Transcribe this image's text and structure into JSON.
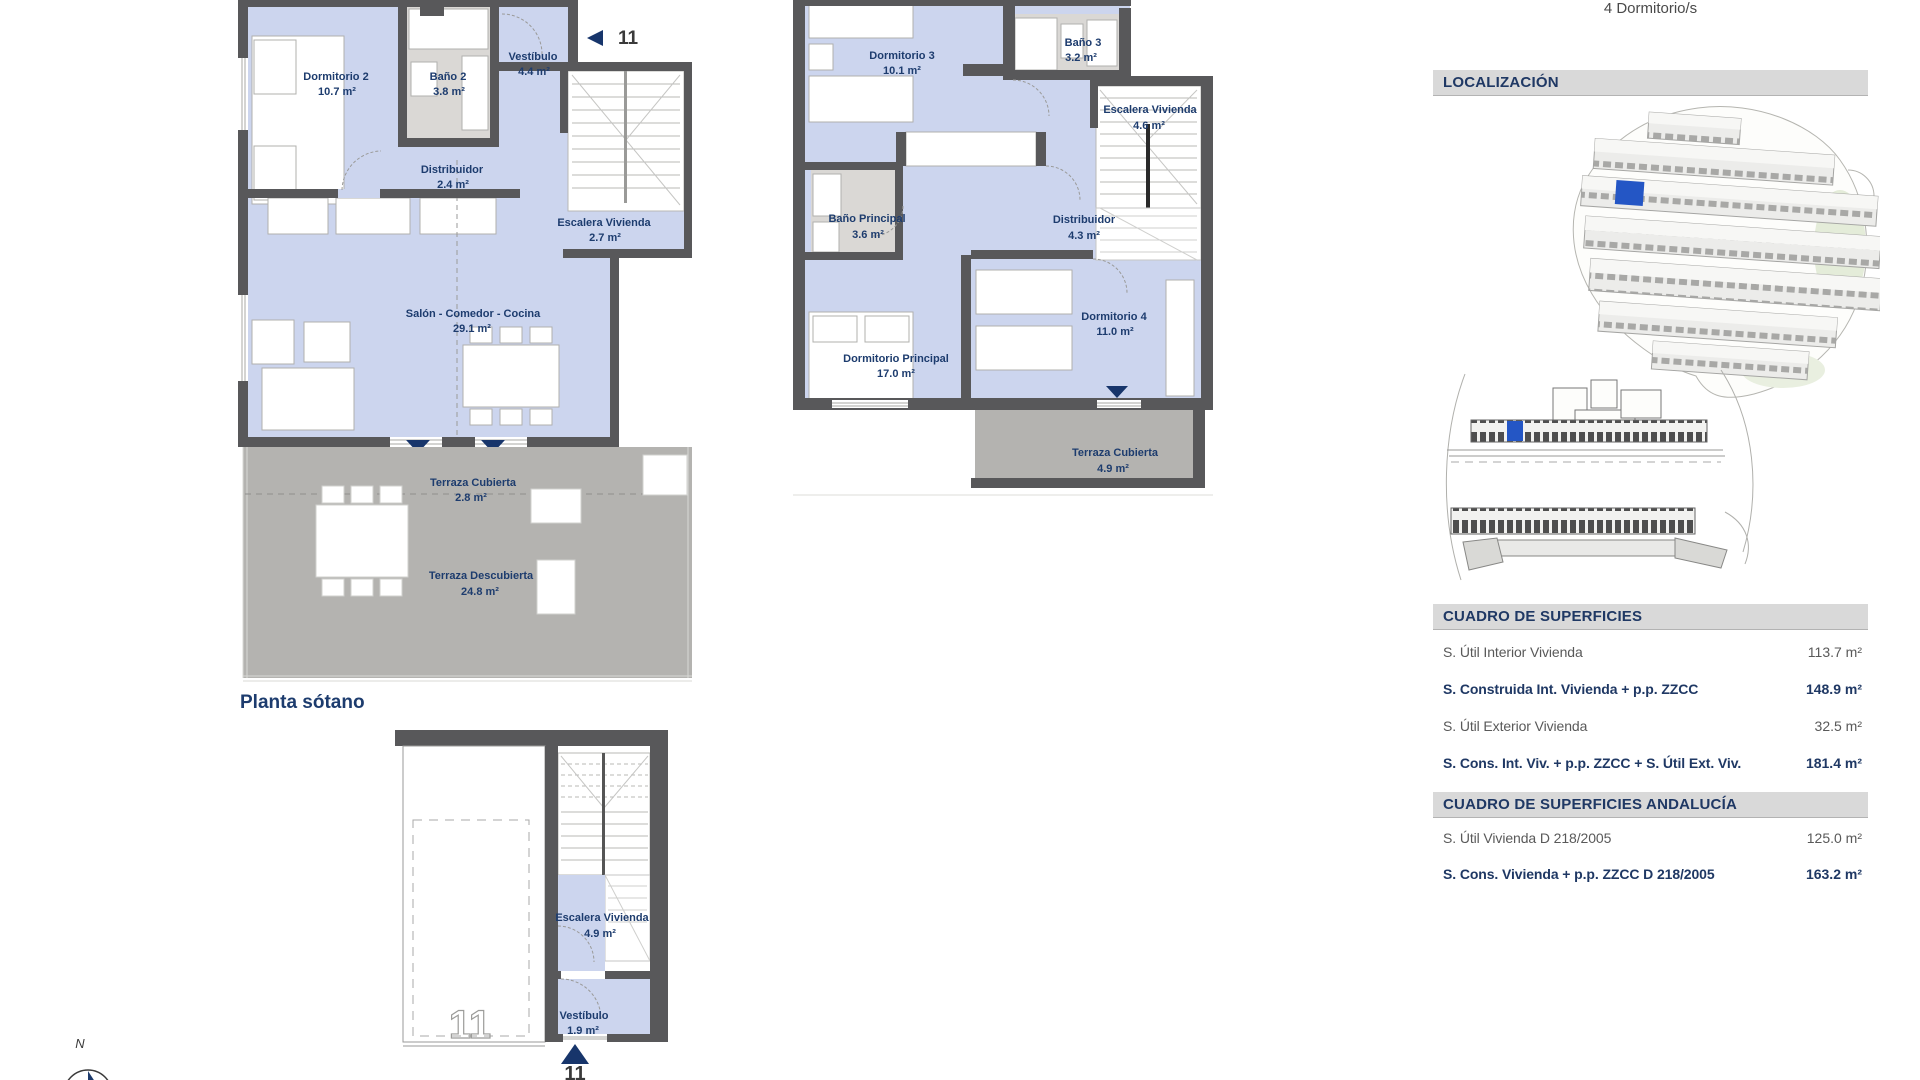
{
  "header": {
    "bedrooms": "4 Dormitorio/s"
  },
  "plans": {
    "ground": {
      "title": "Planta sótano",
      "unit_marker": "11",
      "rooms": {
        "dormitorio2": {
          "name": "Dormitorio 2",
          "area": "10.7 m²"
        },
        "bano2": {
          "name": "Baño 2",
          "area": "3.8 m²"
        },
        "vestibulo": {
          "name": "Vestíbulo",
          "area": "4.4 m²"
        },
        "distribuidor": {
          "name": "Distribuidor",
          "area": "2.4 m²"
        },
        "escalera": {
          "name": "Escalera Vivienda",
          "area": "2.7 m²"
        },
        "salon": {
          "name": "Salón - Comedor - Cocina",
          "area": "29.1 m²"
        },
        "terraza_cubierta": {
          "name": "Terraza Cubierta",
          "area": "2.8 m²"
        },
        "terraza_descubierta": {
          "name": "Terraza Descubierta",
          "area": "24.8 m²"
        }
      }
    },
    "first": {
      "rooms": {
        "dormitorio3": {
          "name": "Dormitorio 3",
          "area": "10.1 m²"
        },
        "bano3": {
          "name": "Baño 3",
          "area": "3.2 m²"
        },
        "escalera": {
          "name": "Escalera Vivienda",
          "area": "4.6 m²"
        },
        "bano_principal": {
          "name": "Baño Principal",
          "area": "3.6 m²"
        },
        "distribuidor": {
          "name": "Distribuidor",
          "area": "4.3 m²"
        },
        "dormitorio_principal": {
          "name": "Dormitorio Principal",
          "area": "17.0 m²"
        },
        "dormitorio4": {
          "name": "Dormitorio 4",
          "area": "11.0 m²"
        },
        "terraza_cubierta": {
          "name": "Terraza Cubierta",
          "area": "4.9 m²"
        }
      }
    },
    "basement": {
      "unit_marker": "11",
      "garage_marker": "11",
      "rooms": {
        "escalera": {
          "name": "Escalera Vivienda",
          "area": "4.9 m²"
        },
        "vestibulo": {
          "name": "Vestíbulo",
          "area": "1.9 m²"
        }
      }
    }
  },
  "compass": {
    "north": "N"
  },
  "localizacion": {
    "title": "LOCALIZACIÓN"
  },
  "superficies": {
    "title": "CUADRO DE SUPERFICIES",
    "rows": [
      {
        "label": "S. Útil Interior Vivienda",
        "value": "113.7 m²"
      },
      {
        "label": "S. Construida Int. Vivienda + p.p. ZZCC",
        "value": "148.9 m²"
      },
      {
        "label": "S. Útil Exterior Vivienda",
        "value": "32.5 m²"
      },
      {
        "label": "S. Cons. Int. Viv. + p.p. ZZCC + S. Útil Ext. Viv.",
        "value": "181.4 m²"
      }
    ]
  },
  "superficies_andalucia": {
    "title": "CUADRO DE SUPERFICIES ANDALUCÍA",
    "rows": [
      {
        "label": "S. Útil Vivienda D 218/2005",
        "value": "125.0 m²"
      },
      {
        "label": "S. Cons. Vivienda + p.p. ZZCC D 218/2005",
        "value": "163.2 m²"
      }
    ]
  },
  "colors": {
    "navy_text": "#1d3c6e",
    "table_navy": "#1f3864",
    "row_gray": "#595959",
    "wall_gray": "#58585a",
    "room_blue": "#ccd5ee",
    "bath_gray": "#dad8d5",
    "terrace_gray": "#b4b3b0",
    "header_bar": "#d9d9d9",
    "highlight_blue": "#2456c5"
  }
}
